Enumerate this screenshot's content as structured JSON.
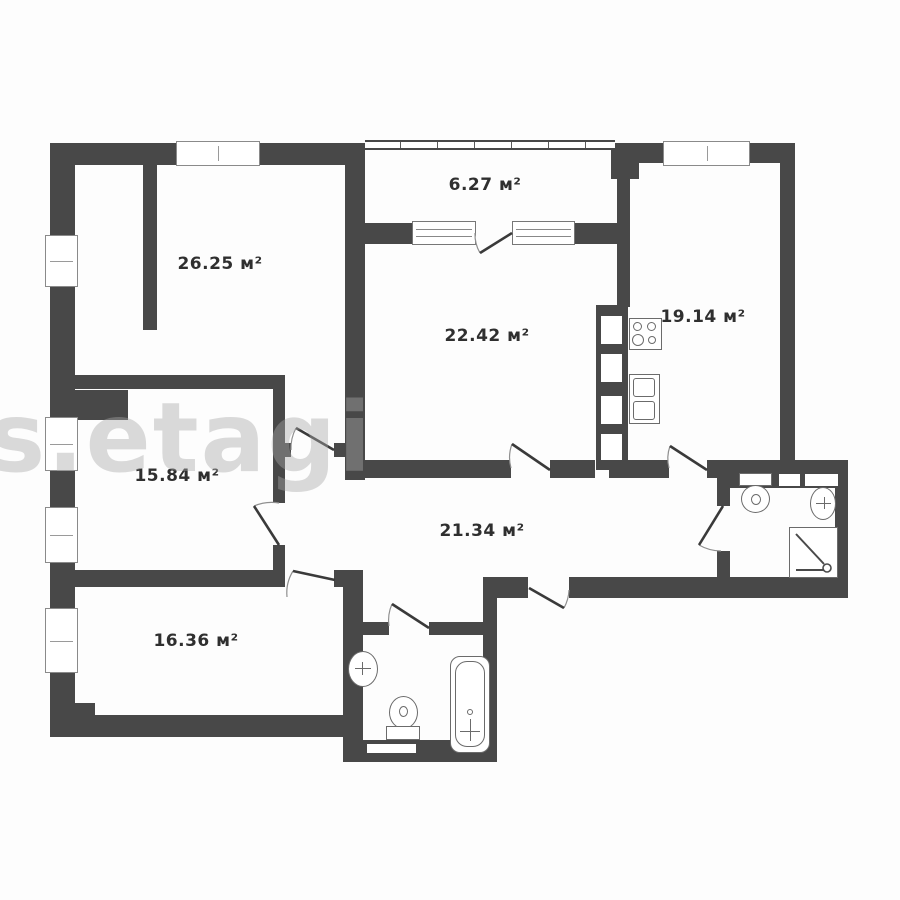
{
  "plan": {
    "type": "apartment-floor-plan",
    "unit": "м²",
    "wall_color": "#484848",
    "background_color": "#fdfdfd",
    "watermark_text": "s.etagi",
    "rooms": [
      {
        "name": "balcony",
        "area_label": "6.27 м²"
      },
      {
        "name": "room-26",
        "area_label": "26.25 м²"
      },
      {
        "name": "room-22",
        "area_label": "22.42 м²"
      },
      {
        "name": "kitchen",
        "area_label": "19.14 м²"
      },
      {
        "name": "room-15",
        "area_label": "15.84 м²"
      },
      {
        "name": "corridor",
        "area_label": "21.34 м²"
      },
      {
        "name": "room-16",
        "area_label": "16.36 м²"
      }
    ],
    "fixtures": {
      "kitchen": [
        "stove-4-burner",
        "double-sink",
        "vent-shaft"
      ],
      "bathroom_bottom": [
        "washbasin",
        "toilet",
        "bathtub"
      ],
      "bathroom_right": [
        "toilet",
        "washbasin",
        "shower-tray"
      ]
    },
    "openings": {
      "windows_left_wall": 4,
      "windows_top_wall": 2,
      "balcony_glazing": 1,
      "doors": 9
    }
  }
}
